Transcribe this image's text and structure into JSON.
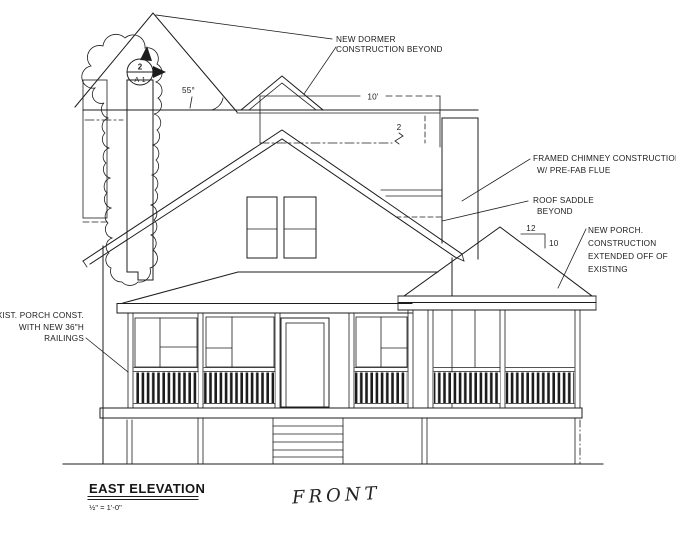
{
  "drawing": {
    "title": "EAST ELEVATION",
    "scale_note": "½\" = 1'-0\"",
    "orientation_label": "FRONT",
    "annotations": {
      "new_dormer_line1": "NEW DORMER",
      "new_dormer_line2": "CONSTRUCTION BEYOND",
      "framed_chimney_line1": "FRAMED CHIMNEY CONSTRUCTION",
      "framed_chimney_line2": "W/ PRE-FAB FLUE",
      "roof_saddle_line1": "ROOF SADDLE",
      "roof_saddle_line2": "BEYOND",
      "new_porch_line1": "NEW PORCH.",
      "new_porch_line2": "CONSTRUCTION",
      "new_porch_line3": "EXTENDED OFF OF",
      "new_porch_line4": "EXISTING",
      "exist_porch_line1": "EXIST. PORCH CONST.",
      "exist_porch_line2": "WITH NEW 36\"H",
      "exist_porch_line3": "RAILINGS"
    },
    "dimensions": {
      "dormer_width": "10'",
      "dormer_step": "2",
      "gable_angle": "55°",
      "pitch_run": "12",
      "pitch_rise": "10"
    },
    "detail_marker": {
      "detail_number": "2",
      "sheet_number": "A-1"
    },
    "colors": {
      "ink": "#1c1c1c",
      "paper": "#ffffff"
    }
  }
}
